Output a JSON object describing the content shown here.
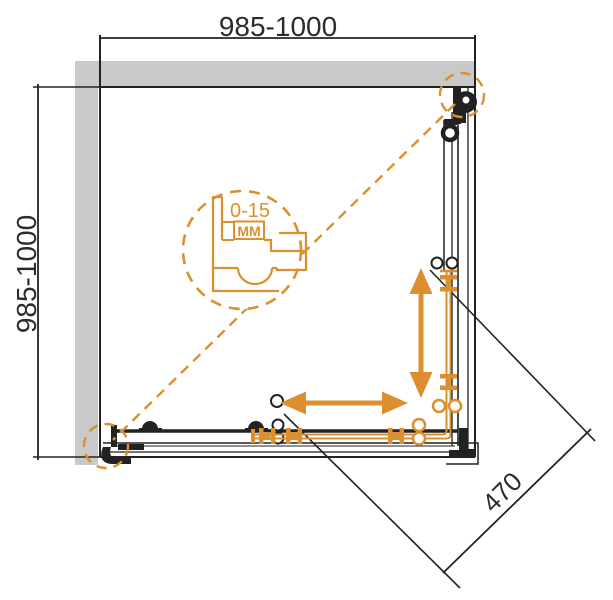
{
  "diagram": {
    "kind": "technical-plan-drawing",
    "subject": "corner shower enclosure with two sliding doors, top view",
    "dimensions": {
      "top_width_mm": "985-1000",
      "left_depth_mm": "985-1000",
      "door_opening_mm": "470",
      "wall_profile_adjustment_range": "0-15",
      "wall_profile_adjustment_unit": "MM"
    },
    "colors": {
      "ink": "#222222",
      "accent": "#DB8F2E",
      "wall-fill": "#c9c9c9",
      "text": "#2c2c2c",
      "background": "#ffffff"
    }
  }
}
